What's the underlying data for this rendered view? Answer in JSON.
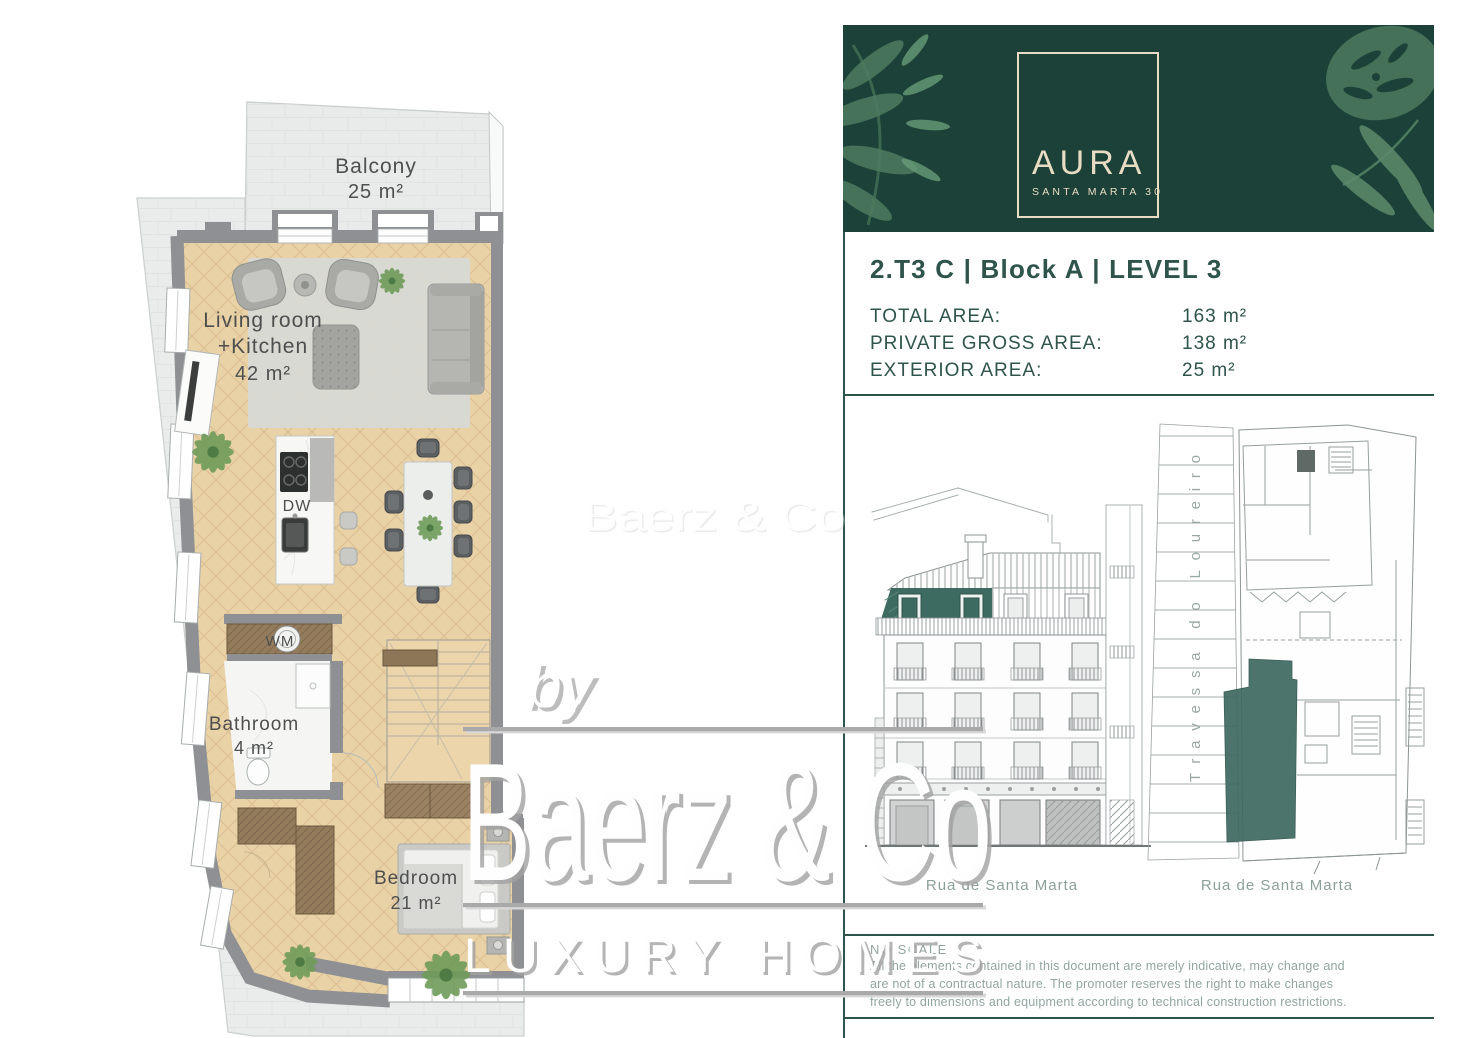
{
  "brand_card": {
    "logo_title": "AURA",
    "logo_subtitle": "SANTA MARTA 30",
    "bg_color": "#1c4138",
    "logo_color": "#e8dcc4"
  },
  "unit_info": {
    "title": "2.T3 C | Block A | LEVEL 3",
    "areas": [
      {
        "label": "TOTAL AREA:",
        "value": "163 m²"
      },
      {
        "label": "PRIVATE GROSS AREA:",
        "value": "138 m²"
      },
      {
        "label": "EXTERIOR AREA:",
        "value": "25 m²"
      }
    ],
    "text_color": "#2e544c"
  },
  "floor_plan": {
    "balcony_name": "Balcony",
    "balcony_area": "25 m²",
    "living_name": "Living room",
    "living_name2": "+Kitchen",
    "living_area": "42 m²",
    "bathroom_name": "Bathroom",
    "bathroom_area": "4 m²",
    "bedroom_name": "Bedroom",
    "bedroom_area": "21 m²",
    "dishwasher_label": "DW",
    "washer_label": "WM",
    "floor_color": "#ead2a7",
    "wall_color": "#8e9093"
  },
  "drawings": {
    "elevation_caption": "Rua de Santa Marta",
    "siteplan_caption": "Rua de Santa Marta",
    "siteplan_street": "Travessa do Loureiro",
    "highlight_color": "#3e6b61"
  },
  "disclaimer": {
    "title": "NO SCALE",
    "line1": "All the elements contained in this document are merely indicative, may change and",
    "line2": "are not of a contractual nature. The promoter reserves the right to make changes",
    "line3": "freely to dimensions and equipment according to technical construction restrictions."
  },
  "watermark": {
    "prefix": "by",
    "brand": "Baerz & Co",
    "tagline": "LUXURY HOMES",
    "ghost": "Baerz & Co"
  }
}
